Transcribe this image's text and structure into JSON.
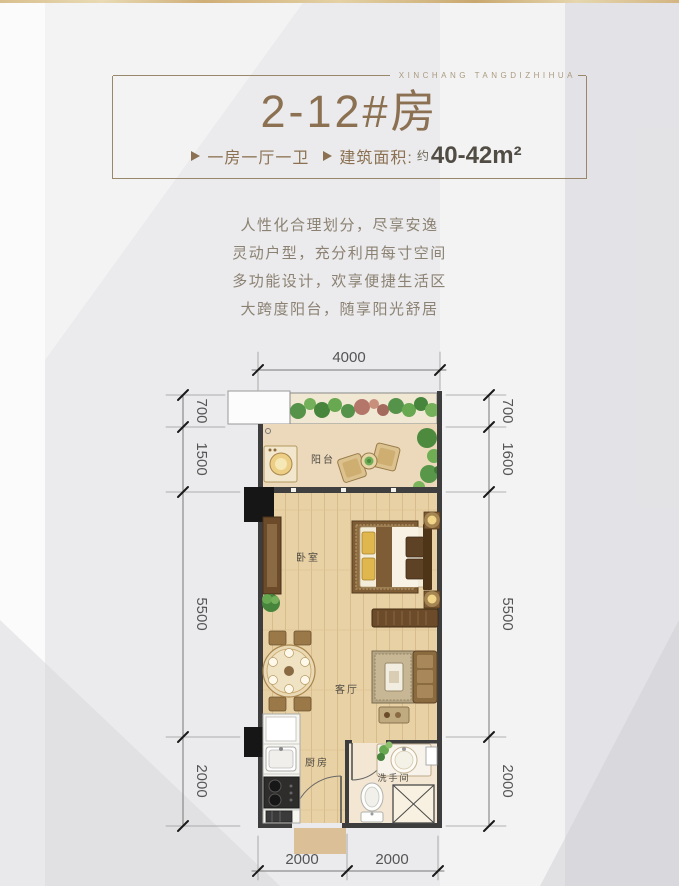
{
  "brand": {
    "tagline": "XINCHANG TANGDIZHIHUA"
  },
  "header": {
    "title": "2-12#房",
    "features": [
      {
        "text": "一房一厅一卫"
      },
      {
        "text": "建筑面积:",
        "approx": "约",
        "value": "40-42m²"
      }
    ]
  },
  "description": {
    "lines": [
      "人性化合理划分，尽享安逸",
      "灵动户型，充分利用每寸空间",
      "多功能设计，欢享便捷生活区",
      "大跨度阳台，随享阳光舒居"
    ]
  },
  "floorplan": {
    "rooms": {
      "balcony": "阳台",
      "bedroom": "卧室",
      "living": "客厅",
      "kitchen": "厨房",
      "bathroom": "洗手间"
    },
    "dims": {
      "top": [
        "4000"
      ],
      "left": [
        "700",
        "1500",
        "5500",
        "2000"
      ],
      "right": [
        "700",
        "1600",
        "5500",
        "2000"
      ],
      "bottom": [
        "2000",
        "2000"
      ]
    }
  },
  "colors": {
    "accent_gold": "#8b7152",
    "frame_border": "#98876a",
    "dim_text": "#555555",
    "wall": "#3d3d3d",
    "wood_floor": "#e8d1a5",
    "balcony_floor": "#ecd9bb",
    "bath_floor": "#f3e6d3",
    "plant_green": "#55924a",
    "top_strip_gold": "#d9bf8e"
  }
}
